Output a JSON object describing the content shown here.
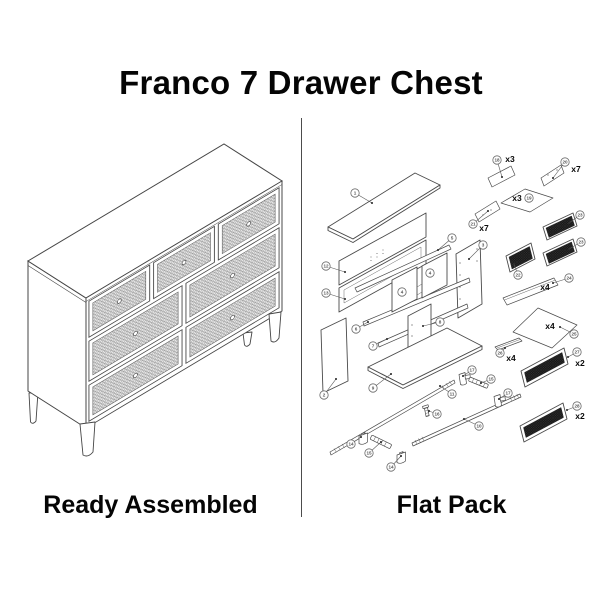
{
  "title": "Franco 7 Drawer Chest",
  "sections": {
    "left": {
      "caption": "Ready Assembled"
    },
    "right": {
      "caption": "Flat Pack"
    }
  },
  "left_illustration": {
    "total_drawers": 7,
    "drawer_rows": [
      3,
      2,
      2
    ]
  },
  "flat_pack": {
    "parts": [
      {
        "num": "1"
      },
      {
        "num": "12"
      },
      {
        "num": "13"
      },
      {
        "num": "5"
      },
      {
        "num": "3"
      },
      {
        "num": "4"
      },
      {
        "num": "4"
      },
      {
        "num": "6"
      },
      {
        "num": "7"
      },
      {
        "num": "8"
      },
      {
        "num": "9"
      },
      {
        "num": "2"
      },
      {
        "num": "11"
      },
      {
        "num": "10"
      },
      {
        "num": "16"
      },
      {
        "num": "14"
      },
      {
        "num": "15"
      },
      {
        "num": "14"
      },
      {
        "num": "17"
      },
      {
        "num": "15"
      },
      {
        "num": "17"
      },
      {
        "num": "18",
        "qty": "x3"
      },
      {
        "num": "20",
        "qty": "x7"
      },
      {
        "num": "19",
        "qty": "x3"
      },
      {
        "num": "21",
        "qty": "x7"
      },
      {
        "num": "22"
      },
      {
        "num": "23"
      },
      {
        "num": "23"
      },
      {
        "num": "24",
        "qty": "x4"
      },
      {
        "num": "25",
        "qty": "x4"
      },
      {
        "num": "26",
        "qty": "x4"
      },
      {
        "num": "27",
        "qty": "x2"
      },
      {
        "num": "28",
        "qty": "x2"
      }
    ]
  },
  "colors": {
    "background": "#ffffff",
    "line_art": "#4a4a4a",
    "text": "#050505",
    "mesh_dark": "#161616"
  }
}
